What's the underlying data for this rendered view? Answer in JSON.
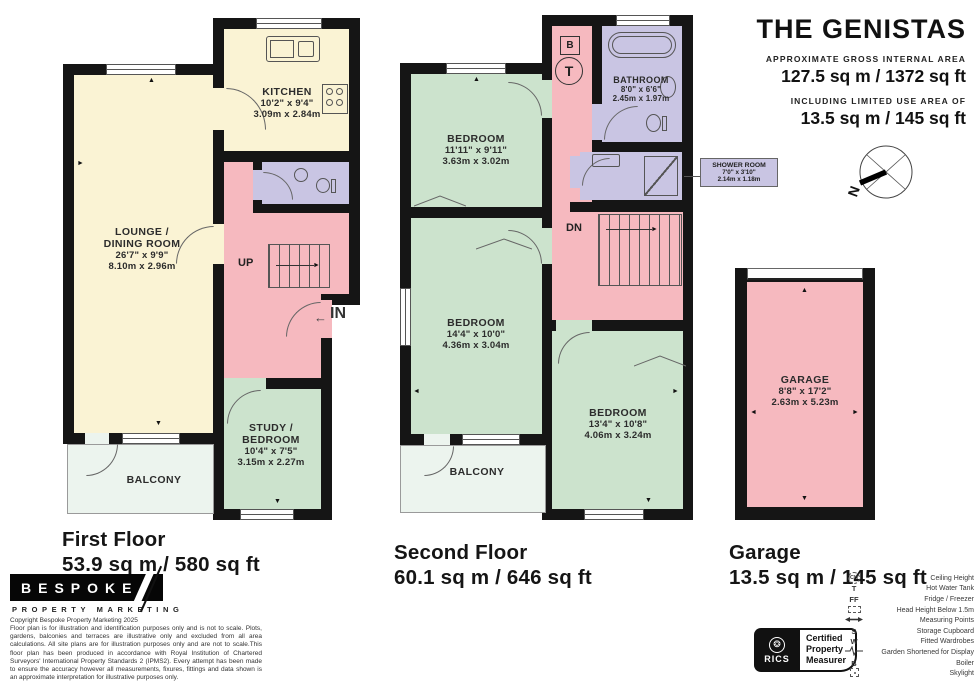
{
  "header": {
    "title": "THE GENISTAS",
    "gross_label": "APPROXIMATE GROSS INTERNAL AREA",
    "gross_value": "127.5 sq m / 1372 sq ft",
    "limited_label": "INCLUDING LIMITED USE AREA OF",
    "limited_value": "13.5 sq m / 145 sq ft"
  },
  "floors": {
    "first": {
      "name": "First Floor",
      "area": "53.9 sq m / 580 sq ft"
    },
    "second": {
      "name": "Second Floor",
      "area": "60.1 sq m / 646 sq ft"
    },
    "garage": {
      "name": "Garage",
      "area": "13.5 sq m / 145 sq ft"
    }
  },
  "rooms": {
    "kitchen": {
      "name": "KITCHEN",
      "imperial": "10'2\" x 9'4\"",
      "metric": "3.09m x 2.84m"
    },
    "lounge": {
      "name_line1": "LOUNGE /",
      "name_line2": "DINING ROOM",
      "imperial": "26'7\" x 9'9\"",
      "metric": "8.10m x 2.96m"
    },
    "study": {
      "name_line1": "STUDY /",
      "name_line2": "BEDROOM",
      "imperial": "10'4\" x 7'5\"",
      "metric": "3.15m x 2.27m"
    },
    "balcony_first": {
      "name": "BALCONY"
    },
    "bedroom1": {
      "name": "BEDROOM",
      "imperial": "11'11\" x 9'11\"",
      "metric": "3.63m x 3.02m"
    },
    "bathroom": {
      "name": "BATHROOM",
      "imperial": "8'0\" x 6'6\"",
      "metric": "2.45m x 1.97m"
    },
    "shower_room": {
      "name": "SHOWER ROOM",
      "imperial": "7'0\" x 3'10\"",
      "metric": "2.14m x 1.18m"
    },
    "bedroom2": {
      "name": "BEDROOM",
      "imperial": "14'4\" x 10'0\"",
      "metric": "4.36m x 3.04m"
    },
    "bedroom3": {
      "name": "BEDROOM",
      "imperial": "13'4\" x 10'8\"",
      "metric": "4.06m x 3.24m"
    },
    "balcony_second": {
      "name": "BALCONY"
    },
    "garage": {
      "name": "GARAGE",
      "imperial": "8'8\" x 17'2\"",
      "metric": "2.63m x 5.23m"
    }
  },
  "markers": {
    "up": "UP",
    "down": "DN",
    "entrance": "IN",
    "boiler": "B",
    "tank": "T",
    "north": "N"
  },
  "branding": {
    "logo_name": "BESPOKE",
    "logo_sub": "PROPERTY MARKETING",
    "copyright_line": "Copyright Bespoke Property Marketing 2025",
    "disclaimer": "Floor plan is for illustration and identification purposes only and is not to scale. Plots, gardens, balconies and terraces are illustrative only and excluded from all area calculations.  All site plans are for illustration purposes only and are not to scale.This floor plan has been produced in accordance with Royal Institution of Chartered Surveyors' International Property Standards 2 (IPMS2). Every attempt has been made to ensure the accuracy however all measurements, fixures, fittings and data shown is an approximate interpretation for illustrative purposes only."
  },
  "rics_badge": {
    "brand": "RICS",
    "line1": "Certified",
    "line2": "Property",
    "line3": "Measurer"
  },
  "legend": {
    "items": [
      {
        "symbol": "CH",
        "label": "Ceiling Height"
      },
      {
        "symbol": "T",
        "label": "Hot Water Tank"
      },
      {
        "symbol": "FF",
        "label": "Fridge / Freezer"
      },
      {
        "symbol": "",
        "label": "Head Height Below 1.5m"
      },
      {
        "symbol": "",
        "label": "Measuring Points"
      },
      {
        "symbol": "S",
        "label": "Storage Cupboard"
      },
      {
        "symbol": "W",
        "label": "Fitted Wardrobes"
      },
      {
        "symbol": "",
        "label": "Garden Shortened for Display"
      },
      {
        "symbol": "B",
        "label": "Boiler"
      },
      {
        "symbol": "",
        "label": "Skylight"
      }
    ]
  },
  "colors": {
    "wall": "#151515",
    "room_yellow": "#FAF3D4",
    "room_green": "#CCE3CD",
    "room_pink": "#F6B9BF",
    "room_lavender": "#C9C5E3",
    "balcony": "#ECF4EE"
  }
}
